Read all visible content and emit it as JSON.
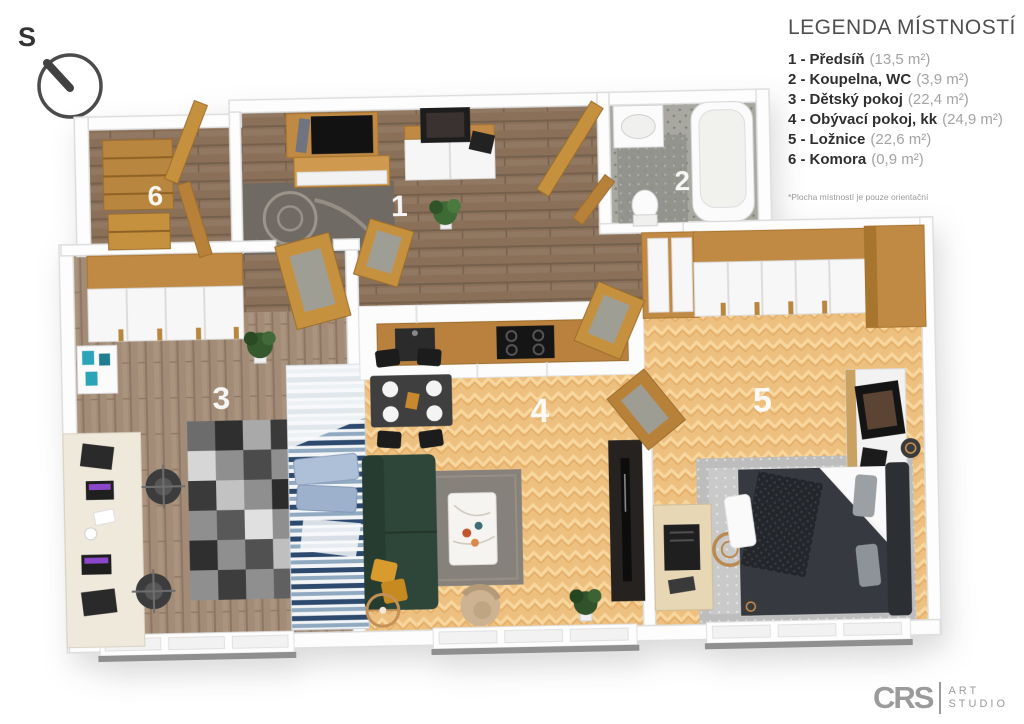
{
  "compass": {
    "label": "S"
  },
  "legend": {
    "title": "LEGENDA MÍSTNOSTÍ",
    "items": [
      {
        "num": "1 -",
        "name": "Předsíň",
        "area": "(13,5 m²)"
      },
      {
        "num": "2 -",
        "name": "Koupelna, WC",
        "area": "(3,9 m²)"
      },
      {
        "num": "3 -",
        "name": "Dětský pokoj",
        "area": "(22,4 m²)"
      },
      {
        "num": "4 -",
        "name": "Obývací pokoj, kk",
        "area": "(24,9 m²)"
      },
      {
        "num": "5 -",
        "name": "Ložnice",
        "area": "(22,6 m²)"
      },
      {
        "num": "6 -",
        "name": "Komora",
        "area": "(0,9 m²)"
      }
    ],
    "footnote": "*Plocha místností je pouze orientační"
  },
  "plan": {
    "room_numbers": {
      "hall": "1",
      "bathroom": "2",
      "kids_room": "3",
      "living_room": "4",
      "bedroom": "5",
      "storage": "6"
    }
  },
  "logo": {
    "initials": "CRS",
    "word1": "ART",
    "word2": "STUDIO"
  },
  "palette": {
    "wood": "#c08a45",
    "parquet_light": "#eec07f",
    "hall_floor": "#8a7058",
    "kids_floor": "#a38c77",
    "bath_tile": "#a8a8a1",
    "sofa_green": "#2e463a",
    "mustard": "#d99b2e",
    "stripe_navy": "#2d4a6e",
    "accent_teal": "#2ba4b8",
    "text_dark": "#2f2f2f",
    "text_light": "#a3a3a3",
    "logo_gray": "#9b9b9b"
  }
}
